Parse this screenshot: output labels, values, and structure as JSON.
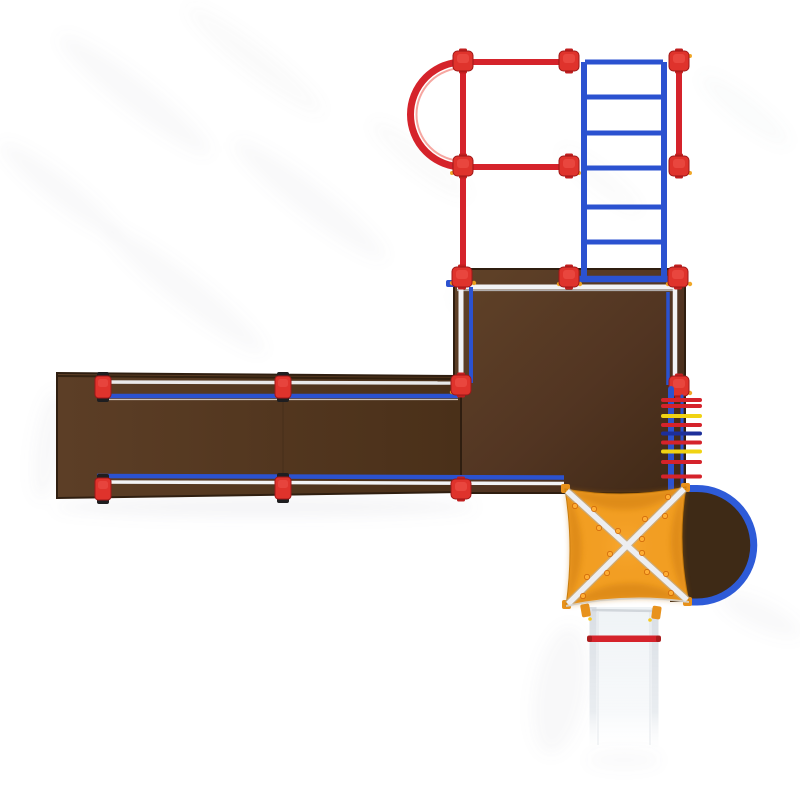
{
  "scene": {
    "name": "playground-structure-top-view-render",
    "background": "#ffffff"
  },
  "palette": {
    "tube_red": "#D5232B",
    "cap_red": "#DF332C",
    "tube_blue": "#2B52D0",
    "arc_blue": "#2E5BD8",
    "rail_white": "#F2F3F5",
    "deck_brown": "#5A3C24",
    "deck_brown_dark": "#412A17",
    "balcony_brown": "#3E2A16",
    "canopy_orange": "#F29E22",
    "canopy_shade": "#C8760A",
    "rivet_orange": "#FFAD33",
    "rung_yellow": "#F0D313",
    "rung_navy": "#1D2F9A",
    "slide_white": "#F3F6F8",
    "slide_edge": "#DCE1E7",
    "hardware_orange": "#E8921C",
    "shadow_gray": "#8B8D96"
  },
  "components": {
    "overhead_frame": {
      "label": "overhead climber frame",
      "loop_arch": "loop arch climber",
      "side_rail": "red side rail"
    },
    "horizontal_ladder": {
      "label": "horizontal ladder (monkey bars)",
      "rung_count": 7
    },
    "main_deck": {
      "label": "square platform deck"
    },
    "ramp": {
      "label": "long ramp walkway",
      "post_count": 6
    },
    "wall_climber": {
      "label": "vertical rung wall climber",
      "rung_count": 9,
      "rung_colors": [
        "red",
        "red",
        "yellow",
        "red",
        "navy",
        "red",
        "yellow",
        "red",
        "red"
      ]
    },
    "canopy": {
      "label": "square fabric shade canopy with X cross braces",
      "rivet_count": 16
    },
    "balcony": {
      "label": "half-round balcony deck with blue rail"
    },
    "slide": {
      "label": "straight slide with red safety bar"
    }
  }
}
